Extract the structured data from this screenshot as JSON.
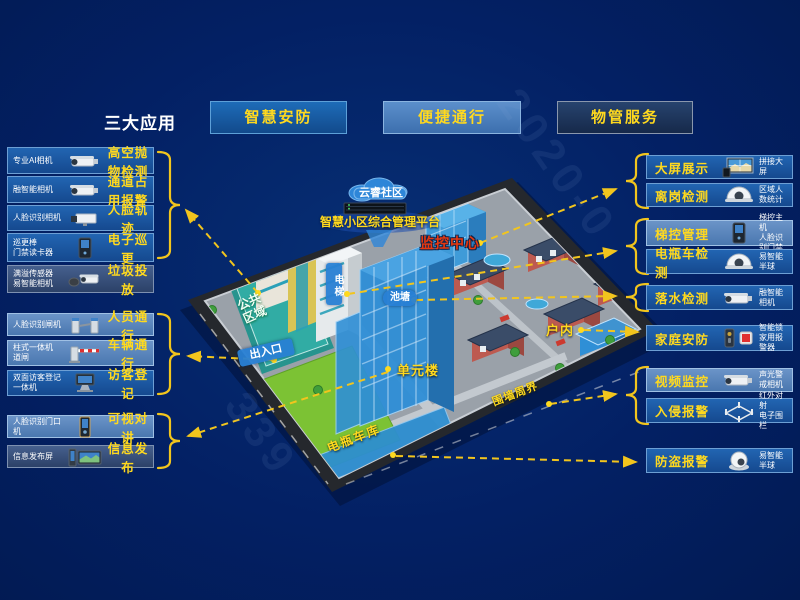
{
  "header": {
    "title": "三大应用",
    "apps": [
      {
        "label": "智慧安防",
        "color": "#1565b0"
      },
      {
        "label": "便捷通行",
        "color": "#4a80c0"
      },
      {
        "label": "物管服务",
        "color": "#203a60"
      }
    ]
  },
  "left_panel": {
    "items": [
      {
        "device": "专业AI相机",
        "feature": "高空抛物检测",
        "icon": "bullet-camera"
      },
      {
        "device": "融智能相机",
        "feature": "通道占用报警",
        "icon": "bullet-camera"
      },
      {
        "device": "人脸识别相机",
        "feature": "人脸轨迹",
        "icon": "box-camera"
      },
      {
        "device": "巡更棒\n门禁读卡器",
        "feature": "电子巡更",
        "icon": "access-panel"
      },
      {
        "device": "满溢传感器\n易智能相机",
        "feature": "垃圾投放",
        "icon": "sensor-camera"
      },
      {
        "device": "人脸识别闸机",
        "feature": "人员通行",
        "icon": "turnstile"
      },
      {
        "device": "柱式一体机\n道闸",
        "feature": "车辆通行",
        "icon": "barrier-gate"
      },
      {
        "device": "双面访客登记\n一体机",
        "feature": "访客登记",
        "icon": "visitor-kiosk"
      },
      {
        "device": "人脸识别门口\n机",
        "feature": "可视对讲",
        "icon": "door-station"
      },
      {
        "device": "信息发布屏",
        "feature": "信息发布",
        "icon": "info-screen"
      }
    ]
  },
  "right_panel": {
    "items": [
      {
        "feature": "大屏展示",
        "device": "拼接大屏",
        "icon": "video-wall"
      },
      {
        "feature": "离岗检测",
        "device": "区域人数统计",
        "icon": "dome-camera"
      },
      {
        "feature": "梯控管理",
        "device": "梯控主机\n人脸识别门禁",
        "icon": "access-panel"
      },
      {
        "feature": "电瓶车检测",
        "device": "易智能半球",
        "icon": "dome-camera"
      },
      {
        "feature": "落水检测",
        "device": "融智能相机",
        "icon": "bullet-camera"
      },
      {
        "feature": "家庭安防",
        "device": "智能锁\n家用报警器",
        "icon": "lock-siren"
      },
      {
        "feature": "视频监控",
        "device": "声光警戒相机",
        "icon": "bullet-camera"
      },
      {
        "feature": "入侵报警",
        "device": "红外对射\n电子围栏",
        "icon": "perimeter-fence"
      },
      {
        "feature": "防盗报警",
        "device": "易智能半球",
        "icon": "turret-camera"
      }
    ]
  },
  "map": {
    "cloud_label": "云睿社区",
    "platform_label": "智慧小区综合管理平台",
    "labels": {
      "monitor_center": "监控中心",
      "elevator": "电梯",
      "pond": "池塘",
      "public_area": "公共区域",
      "entrance": "出入口",
      "unit_building": "单元楼",
      "indoor": "户内",
      "perimeter": "围墙周界",
      "ebike_garage": "电瓶车库"
    }
  },
  "watermark": {
    "fragments": [
      "2020-0",
      "339"
    ]
  },
  "colors": {
    "background": "#04205f",
    "accent_yellow": "#ffd91e",
    "connector_yellow": "#f2c51d",
    "alert_red": "#e8380f",
    "row_blue": "#1b5aa6",
    "row_light_blue": "#5c87bd",
    "row_muted": "#3c5a88",
    "map_banner_blue": "#2e86d8"
  }
}
